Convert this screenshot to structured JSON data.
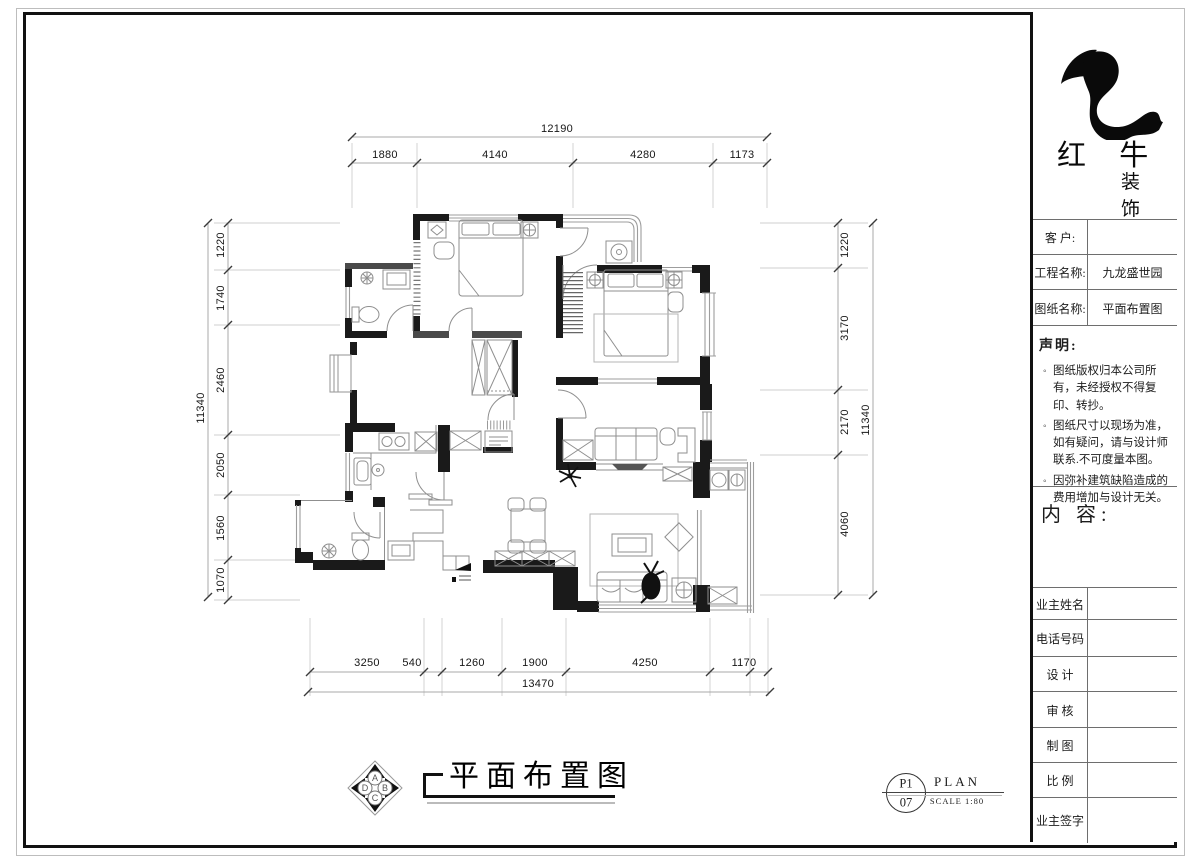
{
  "title_block": {
    "brand": {
      "line1": "红 牛",
      "line2": "装 饰"
    },
    "fields": [
      {
        "label": "客  户:",
        "value": ""
      },
      {
        "label": "工程名称:",
        "value": "九龙盛世园"
      },
      {
        "label": "图纸名称:",
        "value": "平面布置图"
      }
    ],
    "statement": {
      "heading": "声明:",
      "items": [
        "图纸版权归本公司所有，未经授权不得复印、转抄。",
        "图纸尺寸以现场为准，如有疑问，请与设计师联系.不可度量本图。",
        "因弥补建筑缺陷造成的费用增加与设计无关。"
      ]
    },
    "content_label": "内 容:",
    "rows": [
      "业主姓名",
      "电话号码",
      "设 计",
      "审 核",
      "制 图",
      "比 例",
      "业主签字"
    ]
  },
  "caption": {
    "title": "平面布置图"
  },
  "sheet_mark": {
    "number_top": "P1",
    "number_bottom": "07",
    "name": "PLAN",
    "scale": "SCALE 1:80"
  },
  "compass": {
    "top": "A",
    "right": "B",
    "bottom": "C",
    "left": "D"
  },
  "dimensions": {
    "top": {
      "overall": "12190",
      "segments": [
        "1880",
        "4140",
        "4280",
        "1173"
      ]
    },
    "bottom": {
      "overall": "13470",
      "segments": [
        "3250",
        "540",
        "1260",
        "1900",
        "4250",
        "1170"
      ]
    },
    "left": {
      "overall": "11340",
      "segments": [
        "1220",
        "1740",
        "2460",
        "2050",
        "1560",
        "1070"
      ]
    },
    "right": {
      "overall": "11340",
      "segments": [
        "1220",
        "3170",
        "2170",
        "4060"
      ]
    }
  },
  "colors": {
    "wall": "#1a1a1a",
    "partition": "#4a4a4a",
    "accent": "#111111"
  }
}
